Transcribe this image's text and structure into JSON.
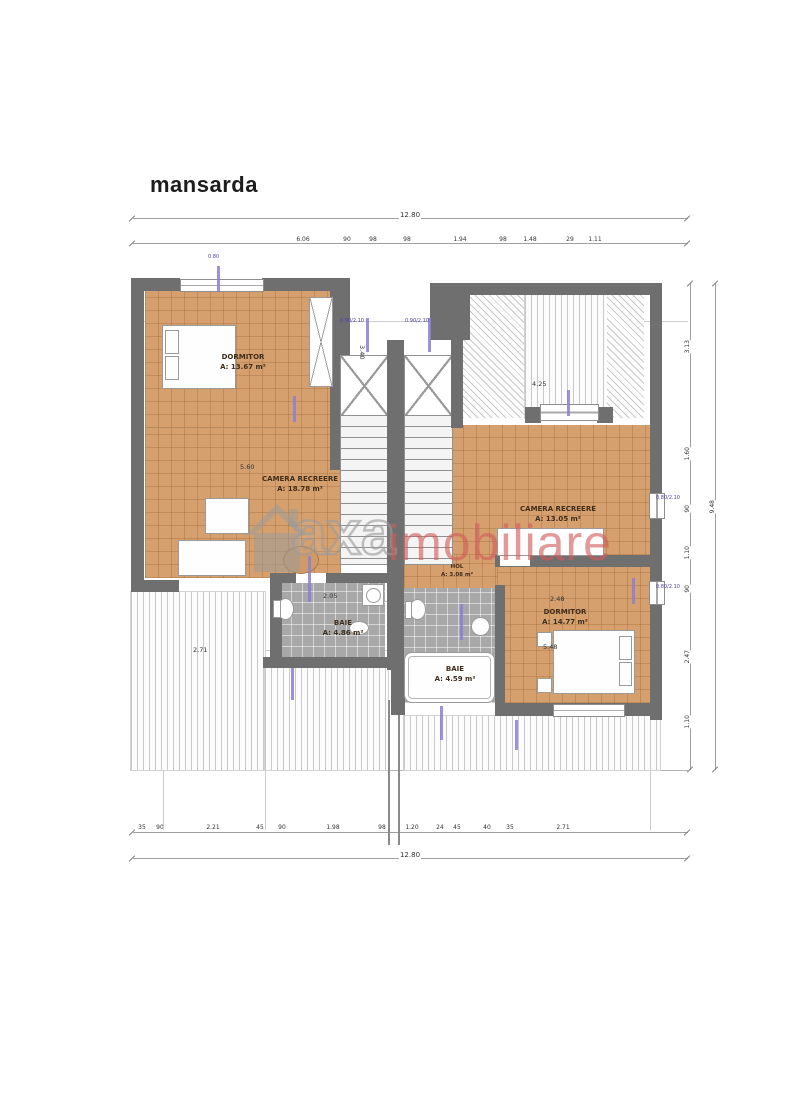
{
  "title": "mansarda",
  "watermark": {
    "brand_gray": "axa",
    "brand_red": "imobiliare",
    "red_hex": "#d35a5a",
    "gray_hex": "#9a9a9a"
  },
  "rooms": {
    "dormitor_left": {
      "name": "DORMITOR",
      "area": "A: 13.67 m²"
    },
    "camera_left": {
      "name": "CAMERA RECREERE",
      "area": "A: 18.78 m²"
    },
    "camera_right": {
      "name": "CAMERA RECREERE",
      "area": "A: 13.05 m²"
    },
    "dormitor_right": {
      "name": "DORMITOR",
      "area": "A: 14.77 m²"
    },
    "baie_left": {
      "name": "BAIE",
      "area": "A: 4.86 m²"
    },
    "baie_right": {
      "name": "BAIE",
      "area": "A: 4.59 m²"
    },
    "hol_right": {
      "name": "HOL",
      "area": "A: 3.08 m²"
    }
  },
  "dims": {
    "overall_top": "12.80",
    "overall_bottom": "12.80",
    "overall_right": "9.48",
    "top": [
      "6.06",
      "90",
      "98",
      "98",
      "1.94",
      "98",
      "1.48",
      "29",
      "1.11"
    ],
    "bottom": [
      "35",
      "90",
      "2.21",
      "45",
      "90",
      "1.98",
      "98",
      "1.20",
      "24",
      "45",
      "40",
      "35",
      "2.71"
    ],
    "right": [
      "3.13",
      "1.60",
      "90",
      "1.10",
      "90",
      "2.47",
      "1.10"
    ],
    "interior": {
      "living_left": "5.60",
      "ridge_right": "4.25",
      "dorm_right_top": "2.48",
      "dorm_right_side": "5.48",
      "terrace_left": "2.71",
      "baie_left": "2.05",
      "dorm_left_side": "3.40"
    }
  },
  "windows": {
    "stair_left": "0.90/2.10",
    "stair_right": "0.90/2.10",
    "right_upper": "0.80/2.10",
    "right_lower": "0.80/2.10",
    "top_left": "0.80"
  }
}
